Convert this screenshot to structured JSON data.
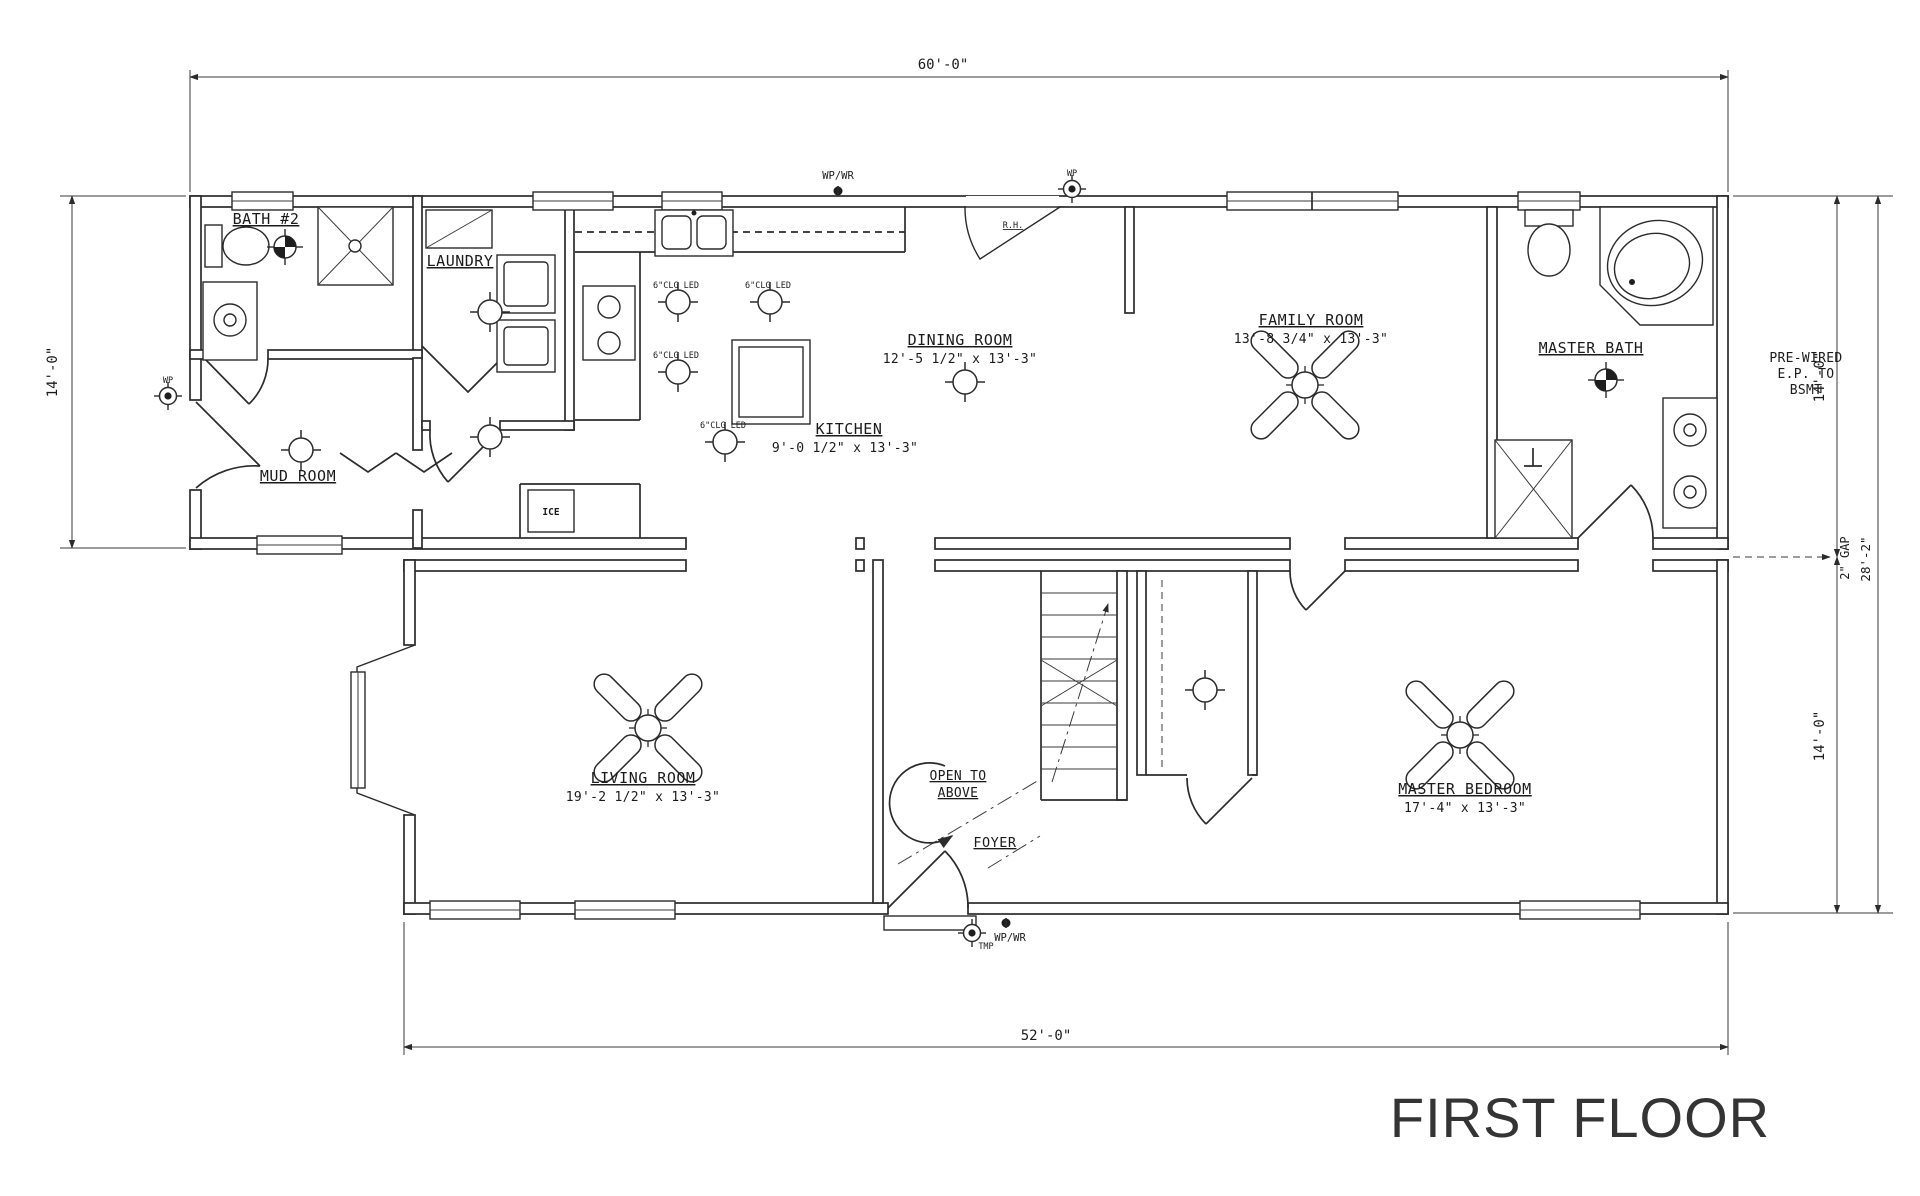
{
  "title": "FIRST FLOOR",
  "dimensions": {
    "top": "60'-0\"",
    "bottom": "52'-0\"",
    "left": "14'-0\"",
    "right_top": "14'-0\"",
    "right_bottom": "14'-0\"",
    "right_gap": "2\" GAP",
    "right_total": "28'-2\""
  },
  "rooms": {
    "bath2": {
      "name": "BATH #2"
    },
    "laundry": {
      "name": "LAUNDRY"
    },
    "mud": {
      "name": "MUD ROOM"
    },
    "kitchen": {
      "name": "KITCHEN",
      "size": "9'-0 1/2\" x 13'-3\""
    },
    "dining": {
      "name": "DINING ROOM",
      "size": "12'-5 1/2\" x 13'-3\""
    },
    "family": {
      "name": "FAMILY ROOM",
      "size": "13'-8 3/4\" x 13'-3\""
    },
    "master_bath": {
      "name": "MASTER BATH"
    },
    "living": {
      "name": "LIVING ROOM",
      "size": "19'-2 1/2\" x 13'-3\""
    },
    "foyer": {
      "name": "FOYER"
    },
    "open_above": {
      "line1": "OPEN TO",
      "line2": "ABOVE"
    },
    "master_bedroom": {
      "name": "MASTER BEDROOM",
      "size": "17'-4\" x 13'-3\""
    }
  },
  "annotations": {
    "wp_wr": "WP/WR",
    "wp": "WP",
    "tmp": "TMP",
    "rh": "R.H.",
    "ice": "ICE",
    "led": "6\"CLG LED",
    "prewired": {
      "line1": "PRE-WIRED",
      "line2": "E.P. TO",
      "line3": "BSMT"
    }
  }
}
